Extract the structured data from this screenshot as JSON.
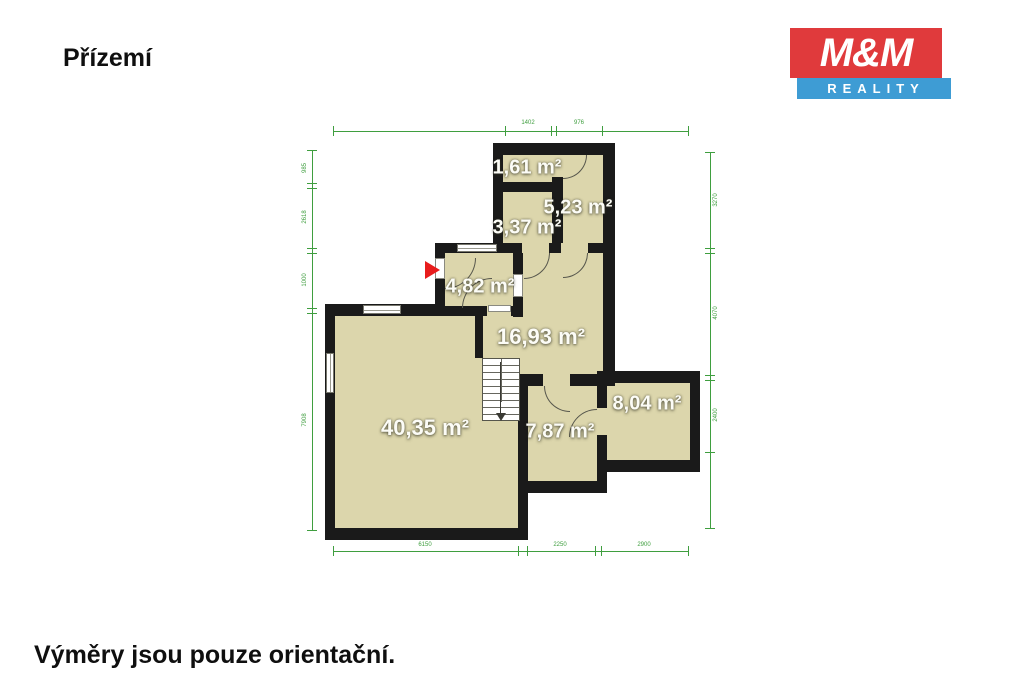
{
  "page": {
    "title": "Přízemí",
    "footer": "Výměry jsou pouze orientační."
  },
  "logo": {
    "line1": "M&M",
    "line2": "REALITY",
    "red": "#e03a3c",
    "blue": "#3e9cd4"
  },
  "floor_plan": {
    "rooms": [
      {
        "id": "room-1-61",
        "area_label": "1,61 m²"
      },
      {
        "id": "room-5-23",
        "area_label": "5,23 m²"
      },
      {
        "id": "room-3-37",
        "area_label": "3,37 m²"
      },
      {
        "id": "room-4-82",
        "area_label": "4,82 m²"
      },
      {
        "id": "hall-16-93",
        "area_label": "16,93 m²"
      },
      {
        "id": "living-40-35",
        "area_label": "40,35 m²"
      },
      {
        "id": "room-7-87",
        "area_label": "7,87 m²"
      },
      {
        "id": "room-8-04",
        "area_label": "8,04 m²"
      }
    ],
    "dimensions": {
      "top": [
        "1402",
        "976"
      ],
      "left": [
        "985",
        "2618",
        "1000",
        "7908"
      ],
      "right": [
        "3270",
        "4070",
        "2400"
      ],
      "bottom": [
        "6150",
        "2250",
        "2900"
      ]
    },
    "colors": {
      "room_fill": "#dcd6ac",
      "wall": "#1a1a1a",
      "dimension_green": "#3f9e3f",
      "entry_marker_red": "#e81c1c"
    }
  }
}
